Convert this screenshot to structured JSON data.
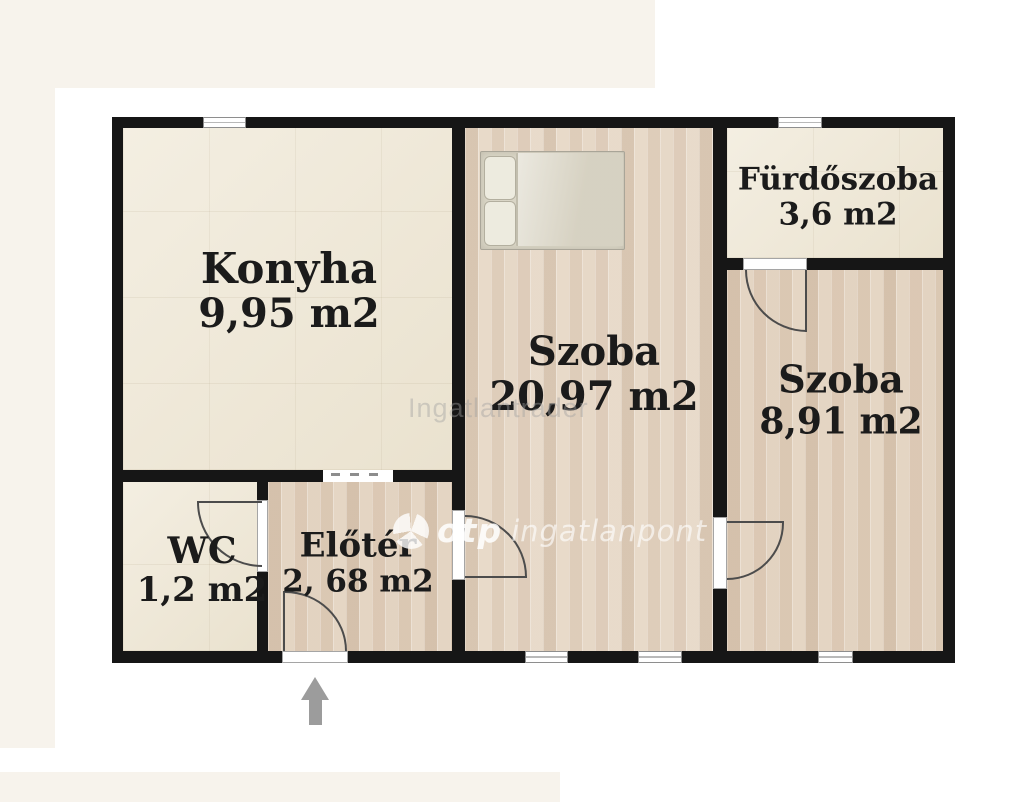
{
  "floorplan": {
    "rooms": [
      {
        "id": "konyha",
        "name": "Konyha",
        "area": "9,95 m2"
      },
      {
        "id": "szoba-middle",
        "name": "Szoba",
        "area": "20,97 m2"
      },
      {
        "id": "furdoszoba",
        "name": "Fürdőszoba",
        "area": "3,6 m2"
      },
      {
        "id": "szoba-right",
        "name": "Szoba",
        "area": "8,91 m2"
      },
      {
        "id": "wc",
        "name": "WC",
        "area": "1,2 m2"
      },
      {
        "id": "eloter",
        "name": "Előtér",
        "area": "2, 68 m2"
      }
    ],
    "watermarks": {
      "diagonal_text": "Ingatlantrader",
      "brand": "otp",
      "brand_suffix": "ingatlanpont"
    },
    "colors": {
      "wall": "#161616",
      "tile_floor": "#f0e9d8",
      "wood_floor": "#e2d2c0",
      "background": "#ffffff",
      "margin_cream": "#f7f3ec",
      "arrow": "#9c9c9c"
    }
  }
}
